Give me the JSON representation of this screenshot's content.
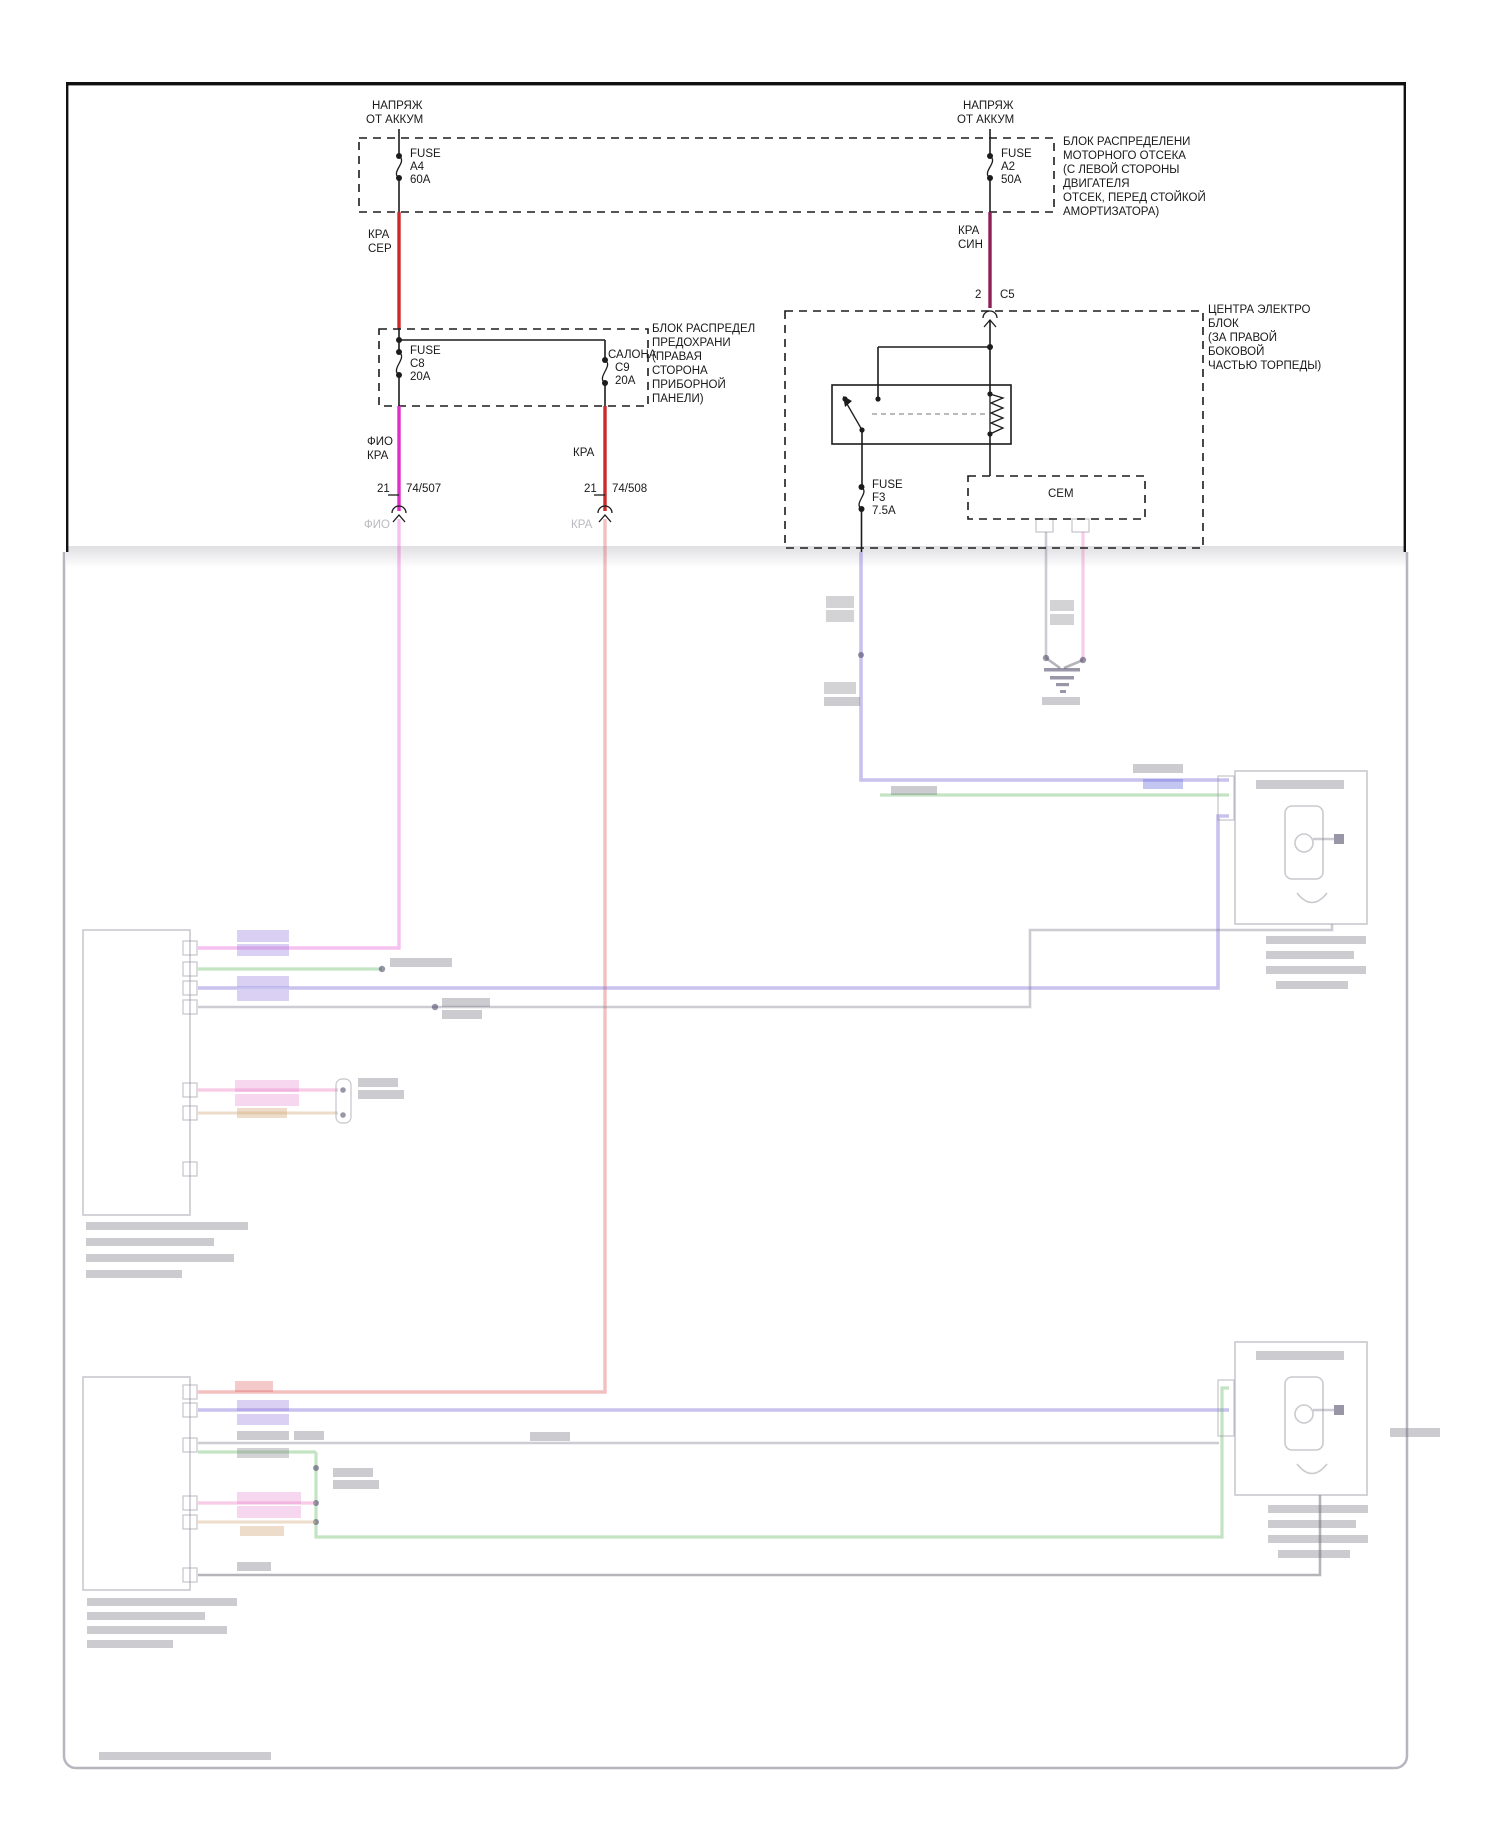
{
  "colors": {
    "wire_red": "#cc2a2a",
    "wire_maroon": "#8e1f55",
    "wire_magenta": "#df2fc8",
    "line_black": "#1c1c1c"
  },
  "top_left": {
    "feed_line1": "НАПРЯЖ",
    "feed_line2": "ОТ АККУМ",
    "fuse_line1": "FUSE",
    "fuse_line2": "A4",
    "fuse_line3": "60A",
    "wire_line1": "КРА",
    "wire_line2": "СЕР"
  },
  "top_right": {
    "feed_line1": "НАПРЯЖ",
    "feed_line2": "ОТ АККУМ",
    "fuse_line1": "FUSE",
    "fuse_line2": "A2",
    "fuse_line3": "50A",
    "wire_line1": "КРА",
    "wire_line2": "СИН",
    "connector_pin": "2",
    "connector_name": "C5"
  },
  "engine_box_note": {
    "line1": "БЛОК РАСПРЕДЕЛЕНИ",
    "line2": "МОТОРНОГО ОТСЕКА",
    "line3": "(С ЛЕВОЙ СТОРОНЫ",
    "line4": "ДВИГАТЕЛЯ",
    "line5": "ОТСЕК, ПЕРЕД СТОЙКОЙ",
    "line6": "АМОРТИЗАТОРА)"
  },
  "interior_fusebox": {
    "fuse_c8": {
      "l1": "FUSE",
      "l2": "C8",
      "l3": "20A"
    },
    "fuse_c9": {
      "l1": "САЛОНА",
      "l2": "C9",
      "l3": "20A"
    },
    "note": {
      "line1": "БЛОК РАСПРЕДЕЛ",
      "line2": "ПРЕДОХРАНИ",
      "line3": "(ПРАВАЯ",
      "line4": "СТОРОНА",
      "line5": "ПРИБОРНОЙ",
      "line6": "ПАНЕЛИ)"
    },
    "wire_left_l1": "ФИО",
    "wire_left_l2": "КРА",
    "wire_right": "КРА",
    "conn_left_pin": "21",
    "conn_left_id": "74/507",
    "conn_right_pin": "21",
    "conn_right_id": "74/508",
    "faded_left": "ФИО",
    "faded_right": "КРА"
  },
  "central_box": {
    "note": {
      "line1": "ЦЕНТРА ЭЛЕКТРО",
      "line2": "БЛОК",
      "line3": "(ЗА ПРАВОЙ",
      "line4": "БОКОВОЙ",
      "line5": "ЧАСТЬЮ ТОРПЕДЫ)"
    },
    "fuse_f3": {
      "l1": "FUSE",
      "l2": "F3",
      "l3": "7.5A"
    },
    "cem_label": "CEM"
  }
}
